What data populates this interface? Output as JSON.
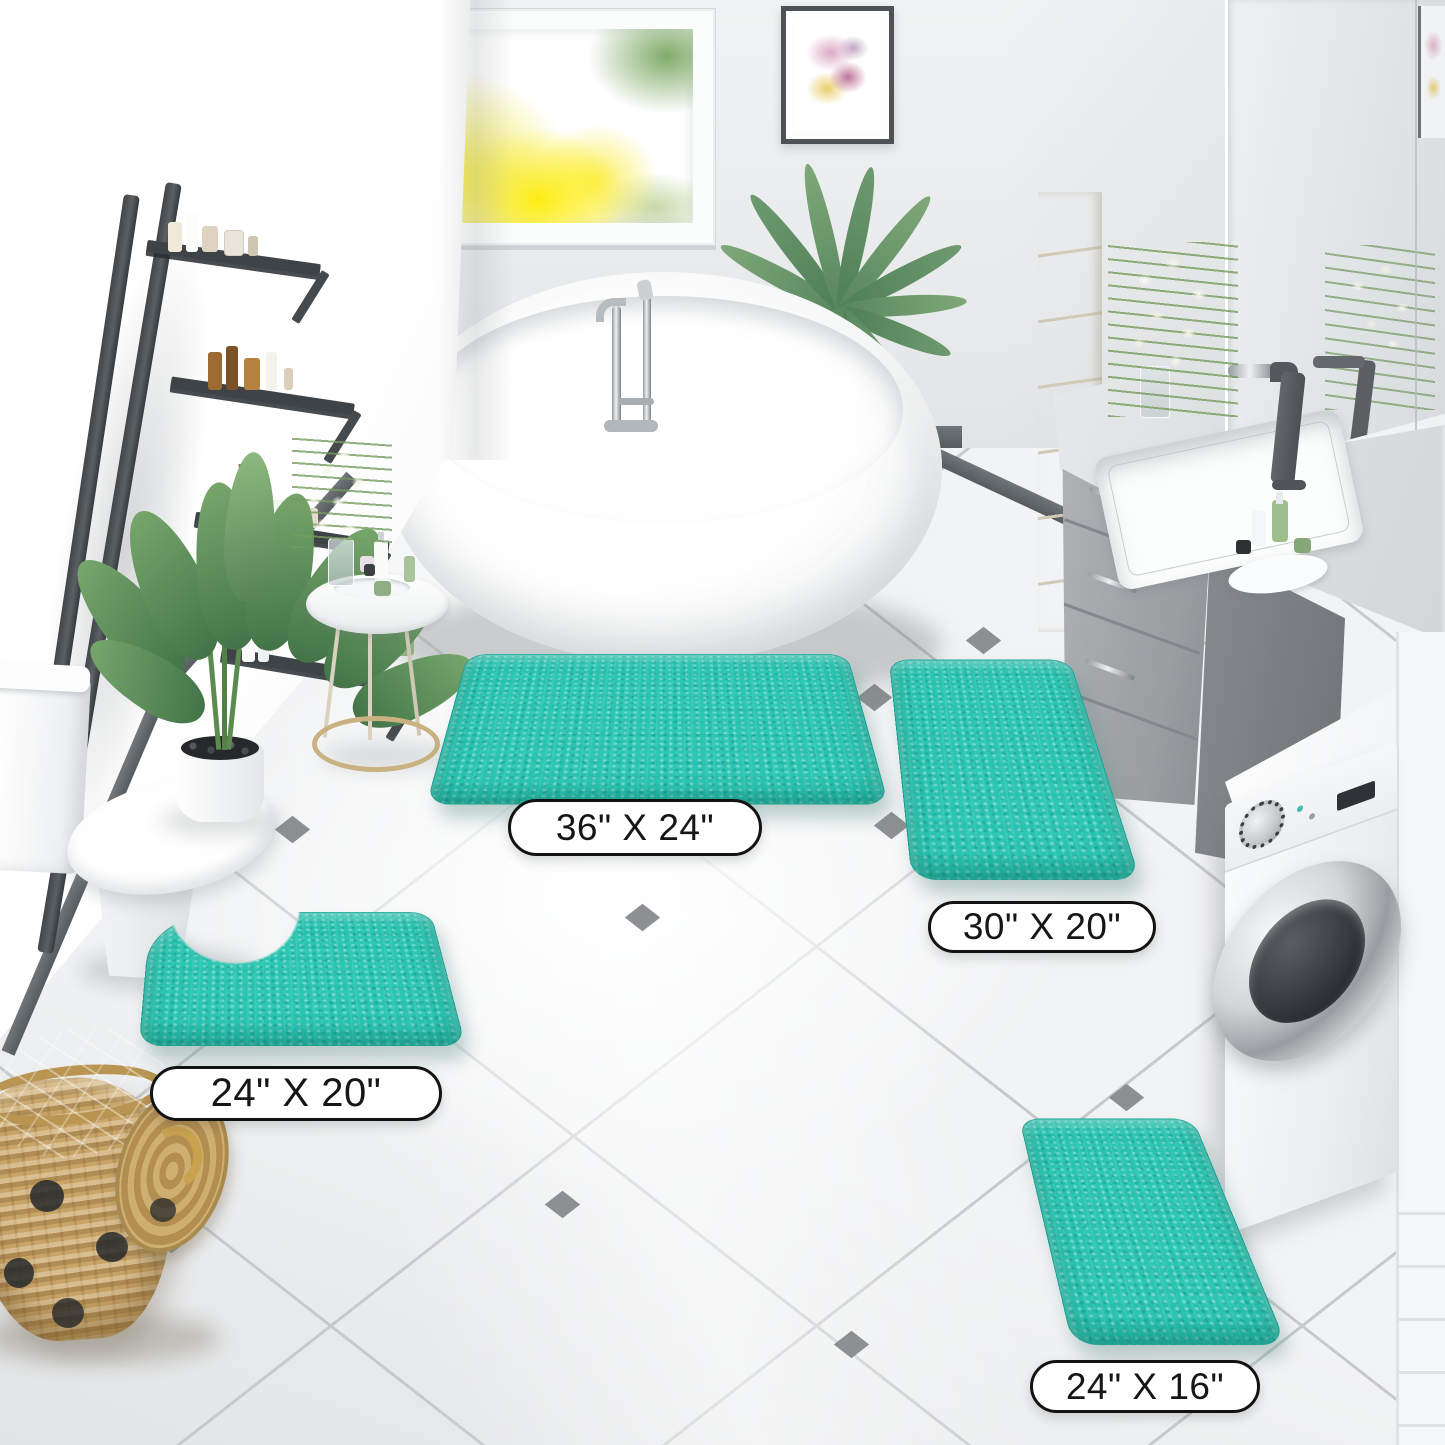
{
  "product": {
    "mat_color_hex": "#2CC7B3",
    "mats": [
      {
        "name": "large-rectangle-mat",
        "size_label": "36\" X 24\""
      },
      {
        "name": "medium-rectangle-mat",
        "size_label": "30\" X 20\""
      },
      {
        "name": "contour-toilet-mat",
        "size_label": "24\" X 20\""
      },
      {
        "name": "small-rectangle-mat",
        "size_label": "24\" X 16\""
      }
    ]
  }
}
